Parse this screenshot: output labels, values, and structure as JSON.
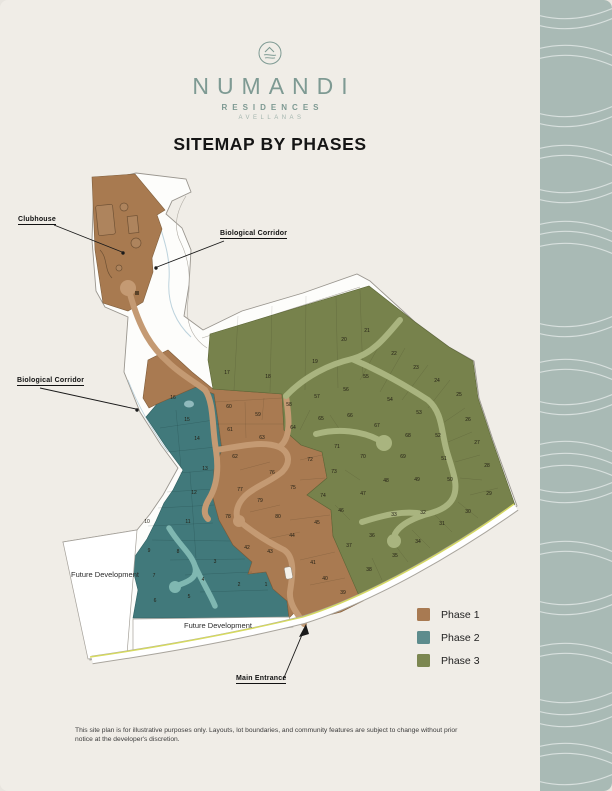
{
  "logo": {
    "name": "NUMANDI",
    "subtitle": "RESIDENCES",
    "location": "AVELLANAS"
  },
  "title": "SITEMAP BY PHASES",
  "map": {
    "labels": {
      "clubhouse": "Clubhouse",
      "bio_corridor_top": "Biological Corridor",
      "bio_corridor_left": "Biological Corridor",
      "future_dev_left": "Future Development",
      "future_dev_bottom": "Future Development",
      "main_entrance": "Main Entrance"
    },
    "phases": [
      {
        "id": "phase1",
        "label": "Phase 1",
        "map_color": "#a97a51",
        "edge_color": "#7f5c39",
        "legend_color": "#a87a52",
        "lots": [
          {
            "n": 39,
            "x": 343,
            "y": 594
          },
          {
            "n": 40,
            "x": 325,
            "y": 580
          },
          {
            "n": 41,
            "x": 313,
            "y": 564
          },
          {
            "n": 42,
            "x": 247,
            "y": 549
          },
          {
            "n": 43,
            "x": 270,
            "y": 553
          },
          {
            "n": 44,
            "x": 292,
            "y": 537
          },
          {
            "n": 45,
            "x": 317,
            "y": 524
          },
          {
            "n": 59,
            "x": 258,
            "y": 416
          },
          {
            "n": 60,
            "x": 229,
            "y": 408
          },
          {
            "n": 61,
            "x": 230,
            "y": 431
          },
          {
            "n": 62,
            "x": 235,
            "y": 458
          },
          {
            "n": 63,
            "x": 262,
            "y": 439
          },
          {
            "n": 72,
            "x": 310,
            "y": 461
          },
          {
            "n": 75,
            "x": 293,
            "y": 489
          },
          {
            "n": 76,
            "x": 272,
            "y": 474
          },
          {
            "n": 77,
            "x": 240,
            "y": 491
          },
          {
            "n": 78,
            "x": 228,
            "y": 518
          },
          {
            "n": 79,
            "x": 260,
            "y": 502
          },
          {
            "n": 80,
            "x": 278,
            "y": 518
          }
        ]
      },
      {
        "id": "phase2",
        "label": "Phase 2",
        "map_color": "#41797b",
        "edge_color": "#2e5f61",
        "legend_color": "#5d8c8d",
        "lots": [
          {
            "n": 1,
            "x": 266,
            "y": 586
          },
          {
            "n": 2,
            "x": 239,
            "y": 586
          },
          {
            "n": 3,
            "x": 215,
            "y": 563
          },
          {
            "n": 4,
            "x": 203,
            "y": 581
          },
          {
            "n": 5,
            "x": 189,
            "y": 598
          },
          {
            "n": 6,
            "x": 155,
            "y": 602
          },
          {
            "n": 7,
            "x": 154,
            "y": 577
          },
          {
            "n": 8,
            "x": 178,
            "y": 553
          },
          {
            "n": 9,
            "x": 149,
            "y": 552
          },
          {
            "n": 10,
            "x": 147,
            "y": 523
          },
          {
            "n": 11,
            "x": 188,
            "y": 523
          },
          {
            "n": 12,
            "x": 194,
            "y": 494
          },
          {
            "n": 13,
            "x": 205,
            "y": 470
          },
          {
            "n": 14,
            "x": 197,
            "y": 440
          },
          {
            "n": 15,
            "x": 187,
            "y": 421
          },
          {
            "n": 16,
            "x": 173,
            "y": 399
          }
        ]
      },
      {
        "id": "phase3",
        "label": "Phase 3",
        "map_color": "#77824c",
        "edge_color": "#5c6637",
        "legend_color": "#7c8751",
        "lots": [
          {
            "n": 17,
            "x": 227,
            "y": 374
          },
          {
            "n": 18,
            "x": 268,
            "y": 378
          },
          {
            "n": 19,
            "x": 315,
            "y": 363
          },
          {
            "n": 20,
            "x": 344,
            "y": 341
          },
          {
            "n": 21,
            "x": 367,
            "y": 332
          },
          {
            "n": 22,
            "x": 394,
            "y": 355
          },
          {
            "n": 23,
            "x": 416,
            "y": 369
          },
          {
            "n": 24,
            "x": 437,
            "y": 382
          },
          {
            "n": 25,
            "x": 459,
            "y": 396
          },
          {
            "n": 26,
            "x": 468,
            "y": 421
          },
          {
            "n": 27,
            "x": 477,
            "y": 444
          },
          {
            "n": 28,
            "x": 487,
            "y": 467
          },
          {
            "n": 29,
            "x": 489,
            "y": 495
          },
          {
            "n": 30,
            "x": 468,
            "y": 513
          },
          {
            "n": 31,
            "x": 442,
            "y": 525
          },
          {
            "n": 32,
            "x": 423,
            "y": 514
          },
          {
            "n": 33,
            "x": 394,
            "y": 516
          },
          {
            "n": 34,
            "x": 418,
            "y": 543
          },
          {
            "n": 35,
            "x": 395,
            "y": 557
          },
          {
            "n": 36,
            "x": 372,
            "y": 537
          },
          {
            "n": 37,
            "x": 349,
            "y": 547
          },
          {
            "n": 38,
            "x": 369,
            "y": 571
          },
          {
            "n": 46,
            "x": 341,
            "y": 512
          },
          {
            "n": 47,
            "x": 363,
            "y": 495
          },
          {
            "n": 48,
            "x": 386,
            "y": 482
          },
          {
            "n": 49,
            "x": 417,
            "y": 481
          },
          {
            "n": 50,
            "x": 450,
            "y": 481
          },
          {
            "n": 51,
            "x": 444,
            "y": 460
          },
          {
            "n": 52,
            "x": 438,
            "y": 437
          },
          {
            "n": 53,
            "x": 419,
            "y": 414
          },
          {
            "n": 54,
            "x": 390,
            "y": 401
          },
          {
            "n": 55,
            "x": 366,
            "y": 378
          },
          {
            "n": 56,
            "x": 346,
            "y": 391
          },
          {
            "n": 57,
            "x": 317,
            "y": 398
          },
          {
            "n": 58,
            "x": 289,
            "y": 406
          },
          {
            "n": 64,
            "x": 293,
            "y": 429
          },
          {
            "n": 65,
            "x": 321,
            "y": 420
          },
          {
            "n": 66,
            "x": 350,
            "y": 417
          },
          {
            "n": 67,
            "x": 377,
            "y": 427
          },
          {
            "n": 68,
            "x": 408,
            "y": 437
          },
          {
            "n": 69,
            "x": 403,
            "y": 458
          },
          {
            "n": 70,
            "x": 363,
            "y": 458
          },
          {
            "n": 71,
            "x": 337,
            "y": 448
          },
          {
            "n": 73,
            "x": 334,
            "y": 473
          },
          {
            "n": 74,
            "x": 323,
            "y": 497
          }
        ]
      }
    ]
  },
  "legend": {
    "items": [
      {
        "label": "Phase 1",
        "color": "#a87a52"
      },
      {
        "label": "Phase 2",
        "color": "#5d8c8d"
      },
      {
        "label": "Phase 3",
        "color": "#7c8751"
      }
    ]
  },
  "colors": {
    "page_bg": "#f0ede7",
    "sidebar_bg": "#a9bab5",
    "road_tan": "#c49a73",
    "road_green": "#a9b47f",
    "road_teal": "#7fb7b1",
    "road_yellow_line": "#d6da5f",
    "logo_green": "#7e9a93"
  },
  "disclaimer": "This site plan is for illustrative purposes only. Layouts, lot boundaries, and community features are subject to change without prior notice at the developer's discretion."
}
